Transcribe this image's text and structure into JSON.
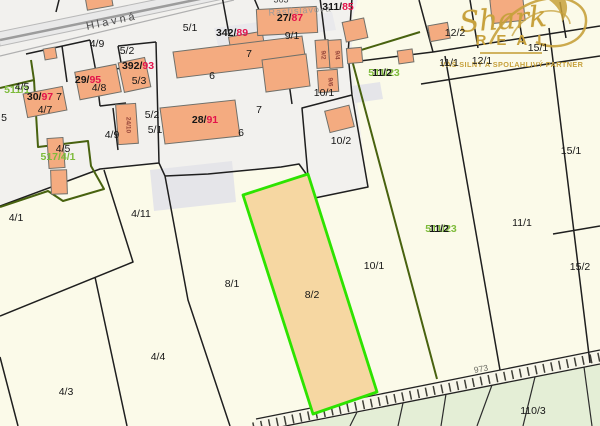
{
  "streets": {
    "hlavna": "Hlavná",
    "rastislavova": "Rastislavova"
  },
  "watermark": {
    "script": "Shark",
    "caps": "REAL",
    "tagline": "VÁŠ SILNÝ A SPOĽAHLIVÝ PARTNER",
    "gold": "#c7a13c"
  },
  "highlight": {
    "label": "8/2",
    "border_color": "#2de300",
    "fill_color": "#f6d7a2"
  },
  "labels": {
    "p4_9a": "4/9",
    "p5_1a": "5/1",
    "p5_2a": "5/2",
    "p5_3": "5/3",
    "p4_8": "4/8",
    "p4_7": "4/7",
    "p4_5a": "4/5",
    "p4_5b": "4/5",
    "p7s": "7",
    "p4_9b": "4/9",
    "p5_2b": "5/2",
    "p5_1b": "5/1",
    "p6a": "6",
    "p7a": "7",
    "p7b": "7",
    "p6b": "6",
    "p9_1": "9/1",
    "p10_1a": "10/1",
    "p10_2": "10/2",
    "p12_2": "12/2",
    "p11_1a": "11/1",
    "p12_1": "12/1",
    "p15_1a": "15/1",
    "p15_1b": "15/1",
    "p15_2": "15/2",
    "p11_1b": "11/1",
    "p10_1b": "10/1",
    "p8_1": "8/1",
    "p8_2": "8/2",
    "p4_1": "4/1",
    "p4_11": "4/11",
    "p4_4": "4/4",
    "p4_3": "4/3",
    "p110_3": "110/3",
    "p5l": "5",
    "road973": "973",
    "n363": "363",
    "c11_2": "11/2"
  },
  "buildings": {
    "b392": {
      "pre": "392/",
      "num": "93"
    },
    "b342": {
      "pre": "342/",
      "num": "89"
    },
    "b311": {
      "pre": "311/",
      "num": "85"
    },
    "b27": {
      "pre": "27/",
      "num": "87"
    },
    "b29": {
      "pre": "29/",
      "num": "95"
    },
    "b30": {
      "pre": "30/",
      "num": "97"
    },
    "b28": {
      "pre": "28/",
      "num": "91"
    },
    "r9_2": "9/2",
    "r9_4": "9/4",
    "r9_6": "9/6",
    "r24": "24/10"
  },
  "e_parcels": {
    "e511_1": "511/1",
    "e517": "517/4/1",
    "e511_23": "511/23"
  },
  "colors": {
    "background": "#fbfae9",
    "built_zone": "#f2f1ee",
    "building_fill": "#f4ab80",
    "green_area": "#e4eed6",
    "boundary_black": "#1f1f1f",
    "boundary_olive": "#48620f",
    "house_number_red": "#e3134b",
    "e_parcel_green": "#7dbb3a",
    "highlight_fill": "#f6d7a2",
    "highlight_border": "#2de300"
  }
}
